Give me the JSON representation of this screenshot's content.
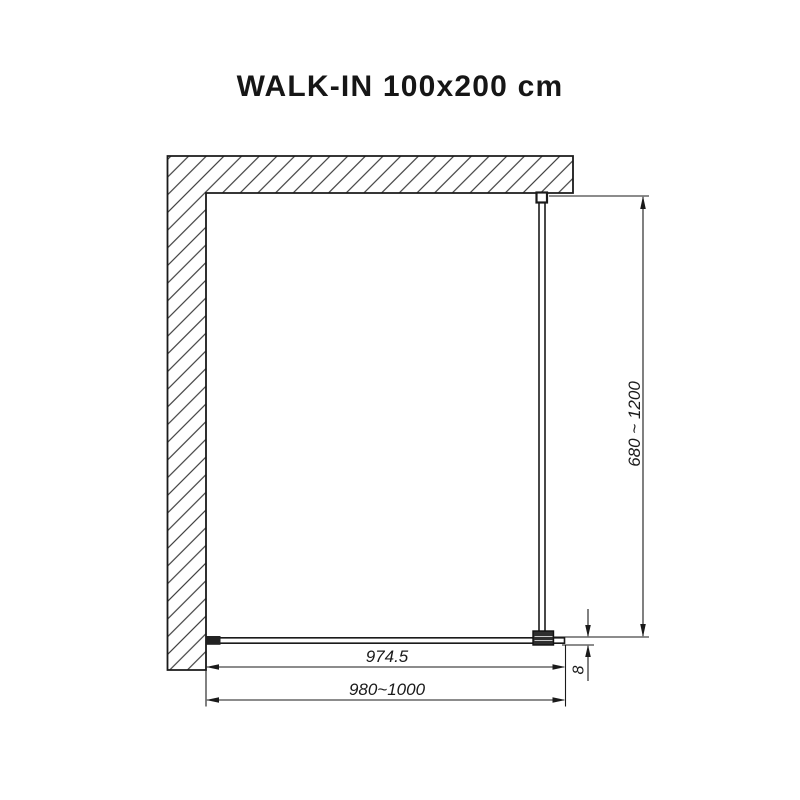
{
  "title": "WALK-IN 100x200 cm",
  "drawing": {
    "type": "technical-plan-view",
    "dimensions": {
      "support_bar_length": "680 ~ 1200",
      "glass_panel_width": "974.5",
      "installation_width": "980~1000",
      "glass_thickness": "8"
    },
    "units_implied": "mm",
    "colors": {
      "line": "#1a1a1a",
      "background": "#ffffff",
      "bracket_fill": "#2f2f2f"
    }
  }
}
